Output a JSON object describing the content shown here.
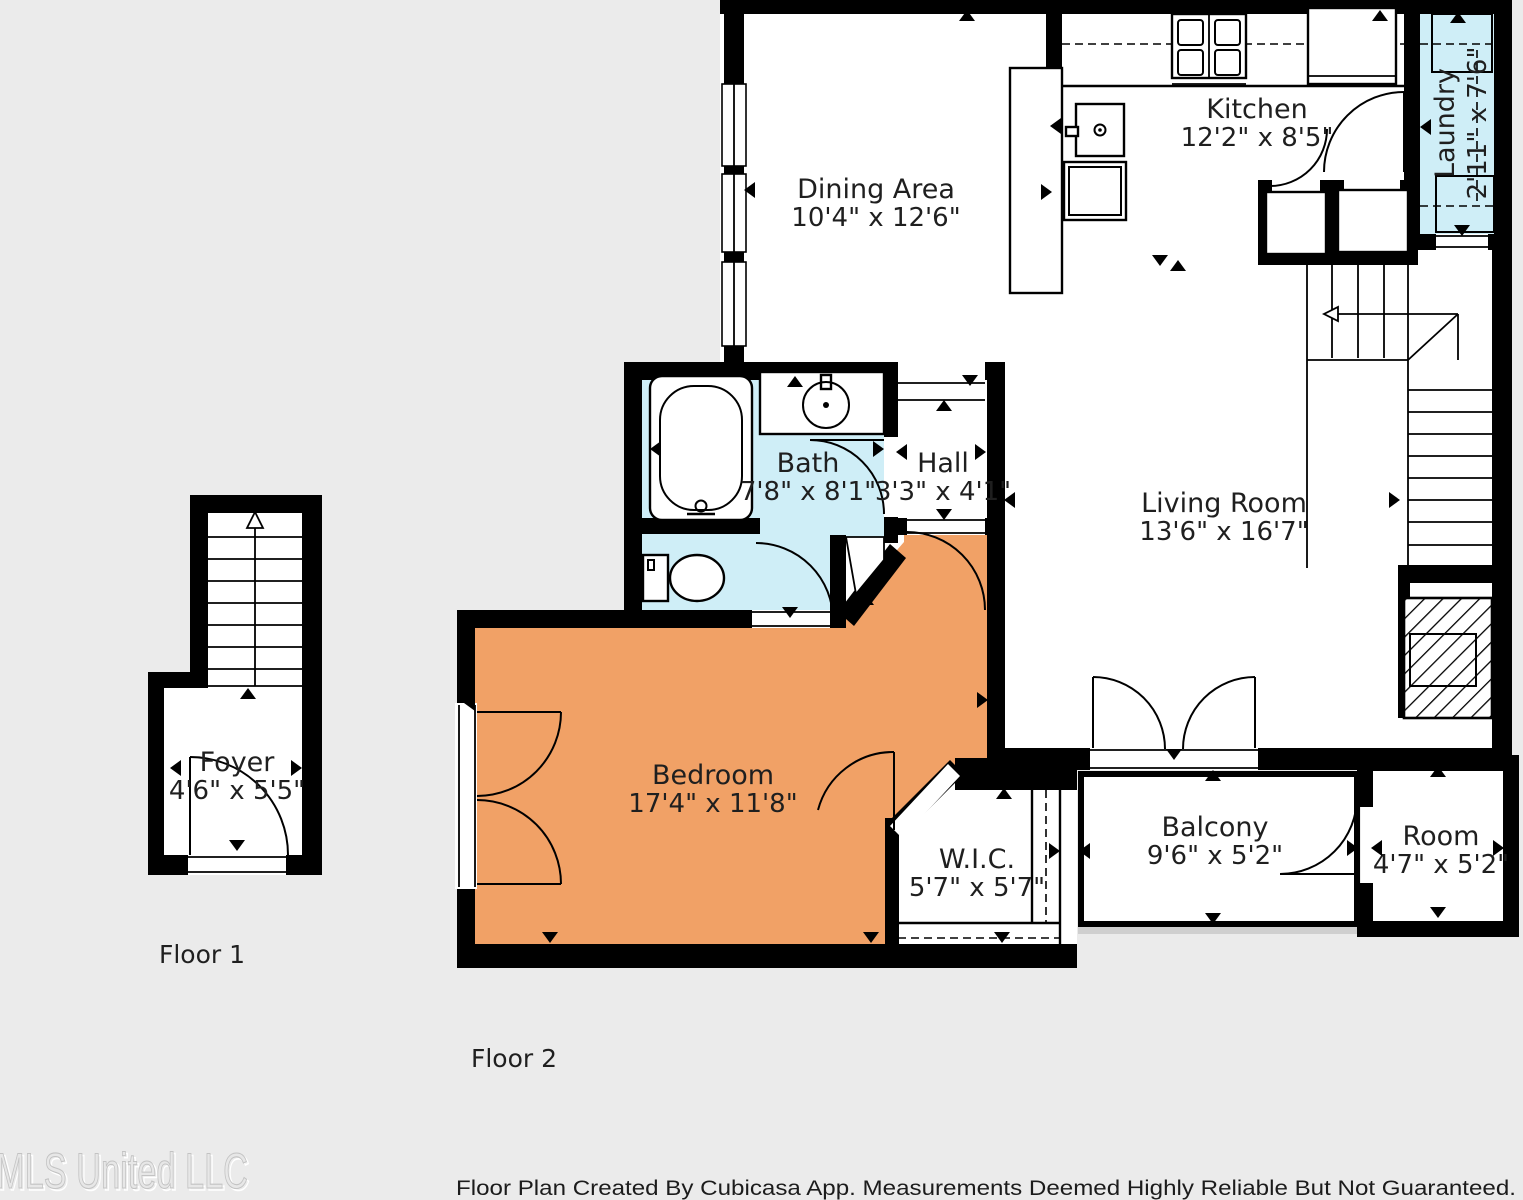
{
  "colors": {
    "background": "#ebebeb",
    "wall": "#000000",
    "wet_room_fill": "#cfeef7",
    "bedroom_fill": "#f1a166",
    "balcony_shadow": "#cfcfcf"
  },
  "rooms": [
    {
      "name": "Dining Area",
      "dims": "10'4\" x 12'6\""
    },
    {
      "name": "Kitchen",
      "dims": "12'2\" x 8'5\""
    },
    {
      "name": "Laundry",
      "dims": "2'11\" x 7'6\""
    },
    {
      "name": "Bath",
      "dims": "7'8\" x 8'1\""
    },
    {
      "name": "Hall",
      "dims": "3'3\" x 4'1\""
    },
    {
      "name": "Living Room",
      "dims": "13'6\" x 16'7\""
    },
    {
      "name": "Bedroom",
      "dims": "17'4\" x 11'8\""
    },
    {
      "name": "W.I.C.",
      "dims": "5'7\" x 5'7\""
    },
    {
      "name": "Balcony",
      "dims": "9'6\" x 5'2\""
    },
    {
      "name": "Room",
      "dims": "4'7\" x 5'2\""
    },
    {
      "name": "Foyer",
      "dims": "4'6\" x 5'5\""
    }
  ],
  "floor_labels": {
    "floor1": "Floor 1",
    "floor2": "Floor 2"
  },
  "footer": {
    "text": "Floor Plan Created By Cubicasa App. Measurements Deemed Highly Reliable But Not Guaranteed."
  },
  "watermark": {
    "text": "MLS United LLC"
  }
}
